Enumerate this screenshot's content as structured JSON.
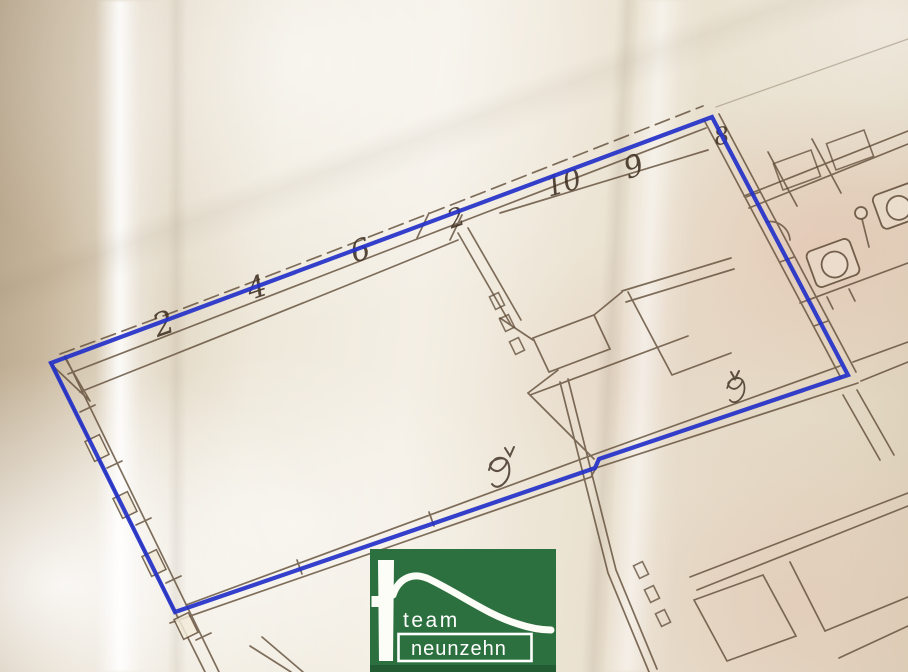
{
  "photo": {
    "description": "Hand-drawn apartment floor plan on creased paper, one unit traced with a blue outline"
  },
  "plan": {
    "ink_color": "#63503b",
    "outline_color": "#2531c8",
    "dimension_labels": [
      {
        "value": "2"
      },
      {
        "value": "4"
      },
      {
        "value": "6"
      },
      {
        "value": "2"
      },
      {
        "value": "10"
      },
      {
        "value": "9"
      },
      {
        "value": "8"
      }
    ],
    "handwritten_marks": [
      "door-squiggle-left",
      "door-squiggle-right",
      "check-mark"
    ]
  },
  "watermark": {
    "line1": "team",
    "line2": "neunzehn",
    "background_color": "#2d7040",
    "text_color": "#ffffff"
  },
  "colors": {
    "paper_light": "#f4efe5",
    "paper_dark": "#b4a288"
  }
}
